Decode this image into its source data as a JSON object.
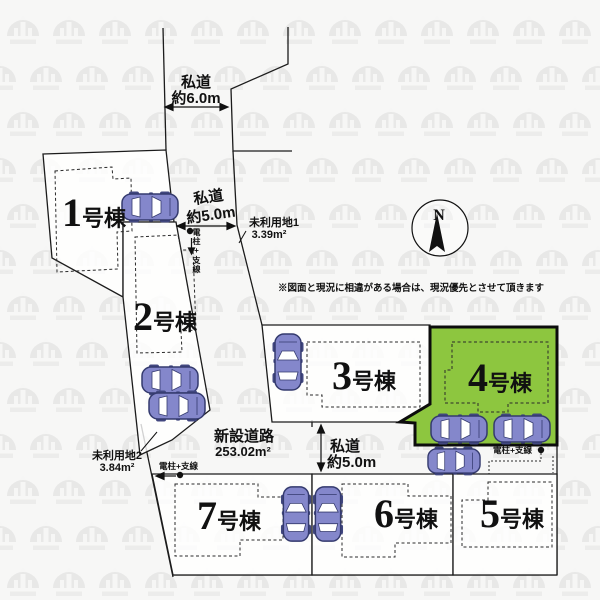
{
  "map": {
    "lots": [
      {
        "number": "1",
        "suffix": "号棟",
        "highlighted": false
      },
      {
        "number": "2",
        "suffix": "号棟",
        "highlighted": false
      },
      {
        "number": "3",
        "suffix": "号棟",
        "highlighted": false
      },
      {
        "number": "4",
        "suffix": "号棟",
        "highlighted": true
      },
      {
        "number": "5",
        "suffix": "号棟",
        "highlighted": false
      },
      {
        "number": "6",
        "suffix": "号棟",
        "highlighted": false
      },
      {
        "number": "7",
        "suffix": "号棟",
        "highlighted": false
      }
    ],
    "roads": {
      "north": {
        "line1": "私道",
        "line2": "約6.0m"
      },
      "east": {
        "line1": "私道",
        "line2": "約5.0m"
      },
      "south": {
        "line1": "私道",
        "line2": "約5.0m"
      },
      "new_road": {
        "line1": "新設道路",
        "line2": "253.02m²"
      }
    },
    "unused_land_1": {
      "line1": "未利用地1",
      "line2": "3.39m²"
    },
    "unused_land_2": {
      "line1": "未利用地2",
      "line2": "3.84m²"
    },
    "utility_pole_label": "電柱+支線",
    "compass_n": "N",
    "disclaimer": "※図面と現況に相違がある場合は、現況優先とさせて頂きます",
    "colors": {
      "highlight": "#8dc63f",
      "car_body": "#8487cb"
    }
  }
}
